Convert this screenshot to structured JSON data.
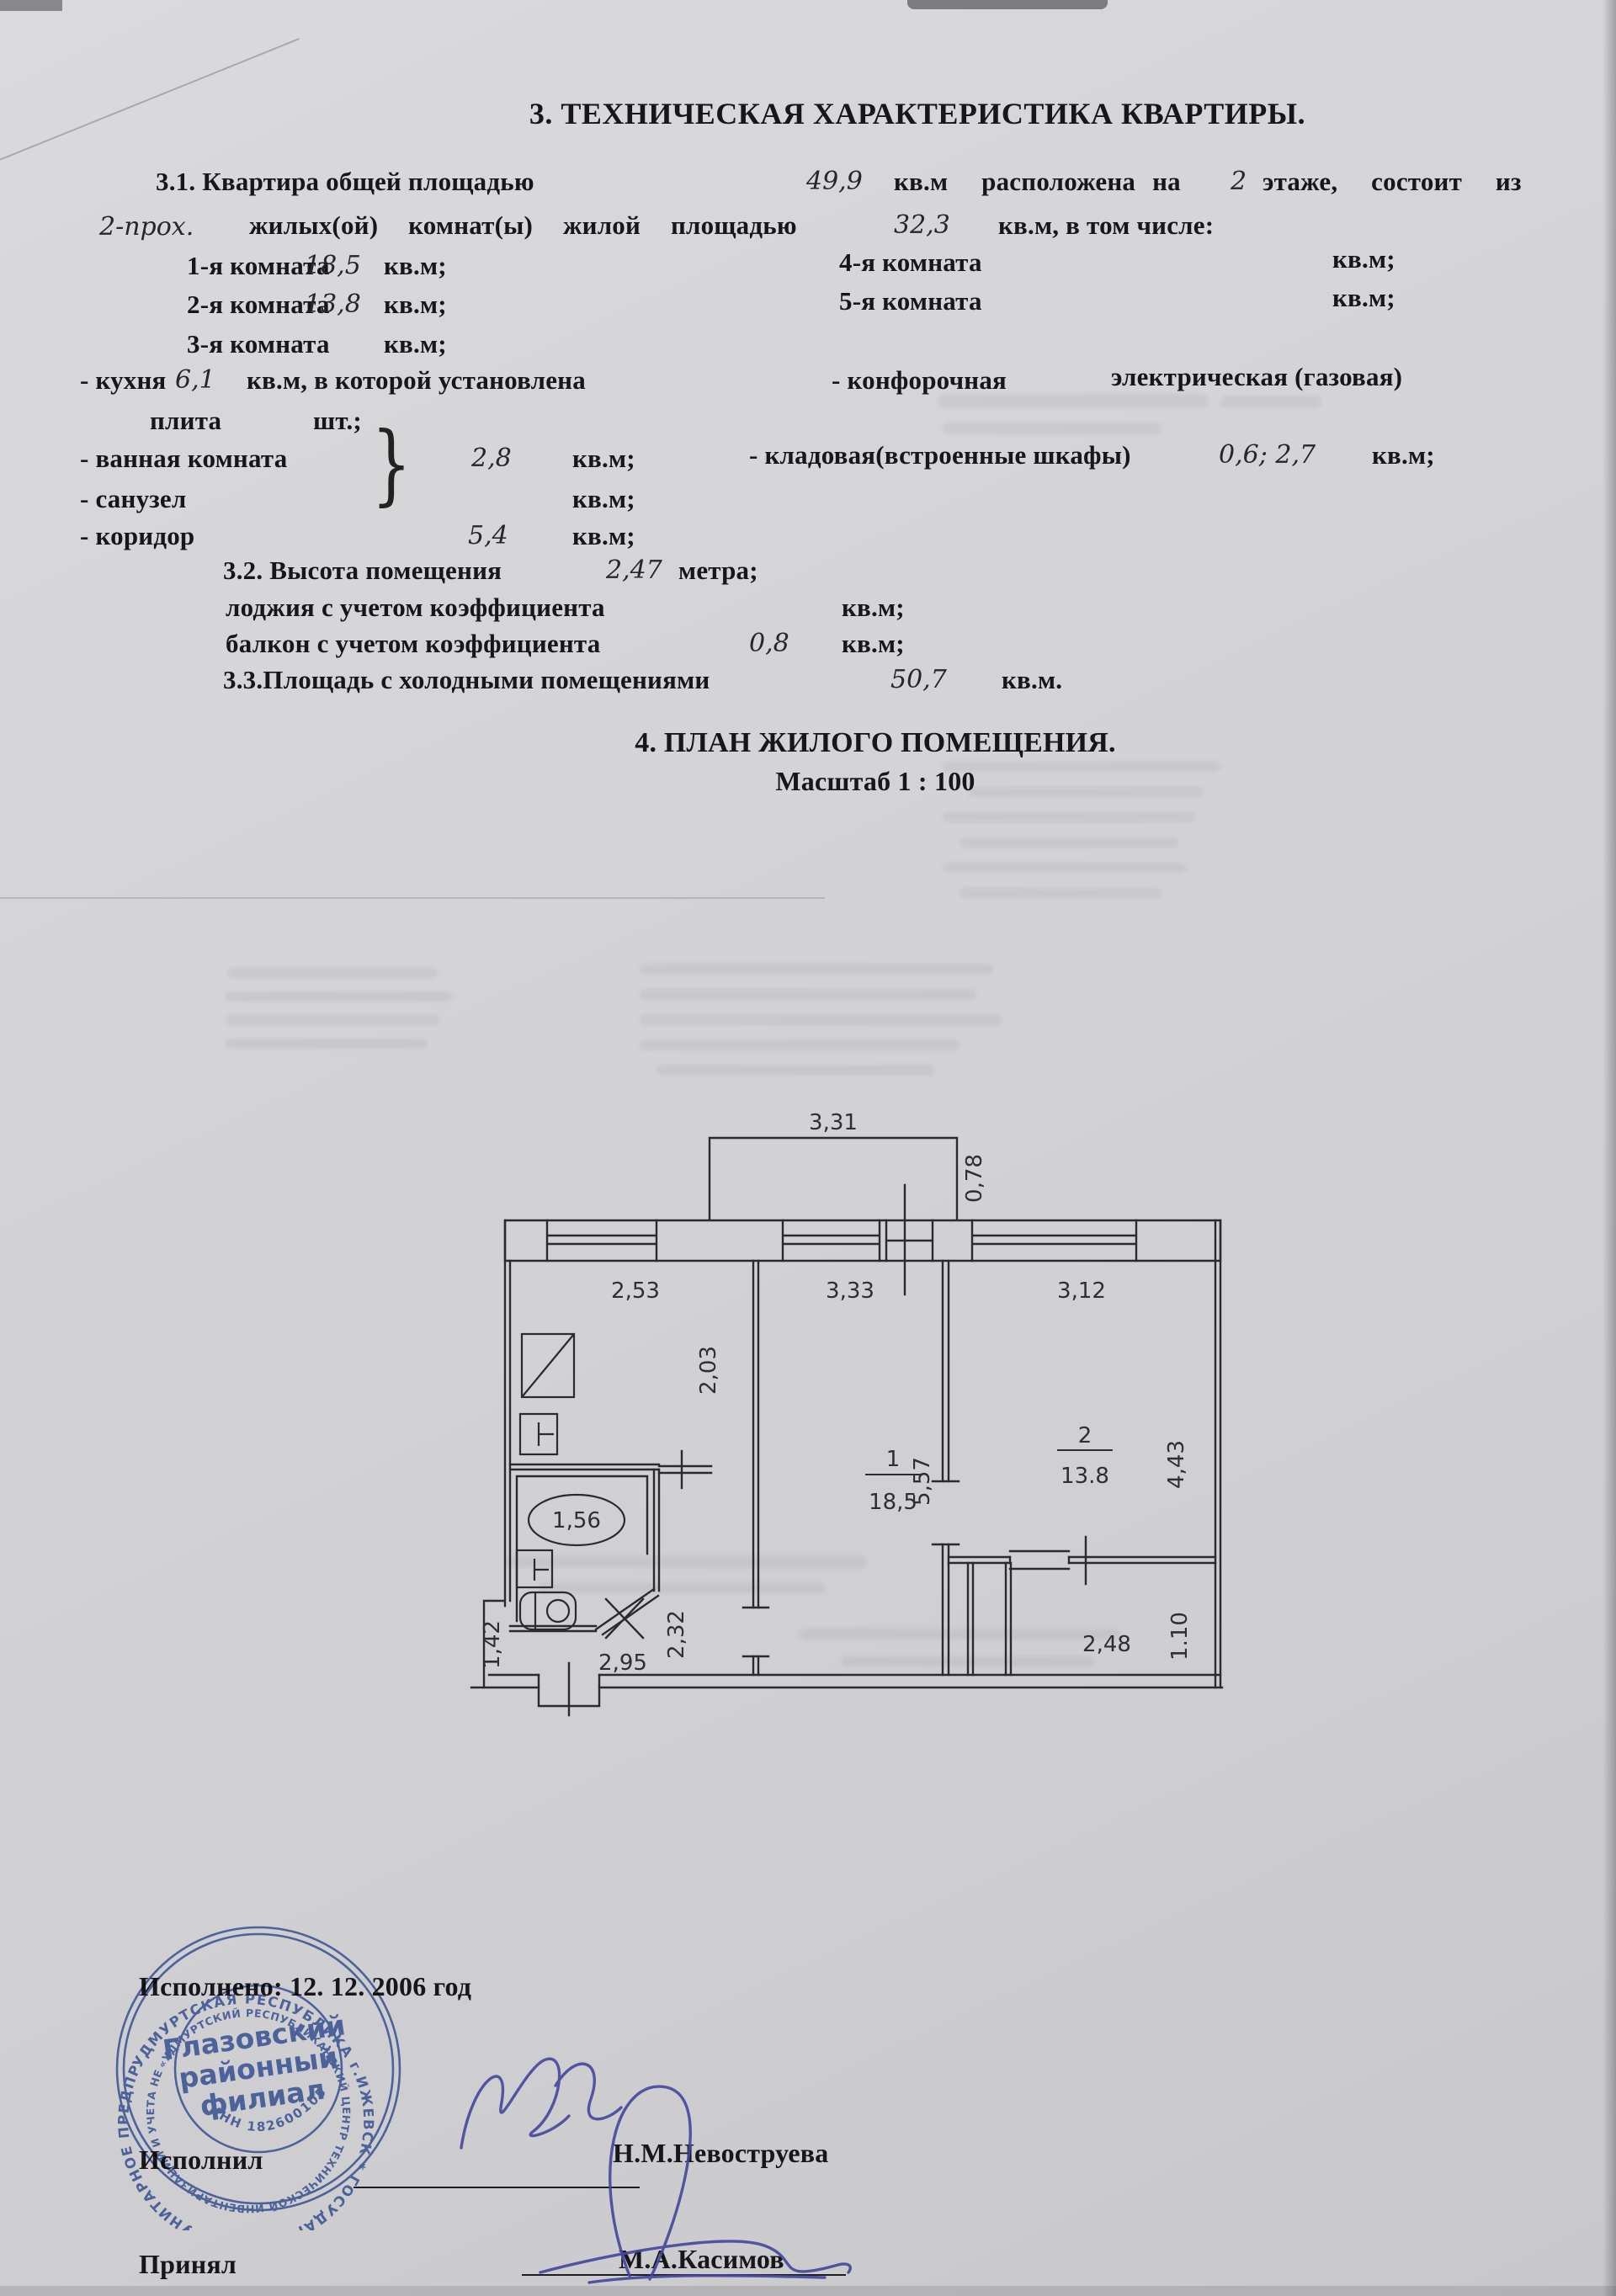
{
  "doc": {
    "section3_title": "3. ТЕХНИЧЕСКАЯ ХАРАКТЕРИСТИКА КВАРТИРЫ.",
    "p31": {
      "lead": "3.1. Квартира общей площадью",
      "total_area": "49,9",
      "mid1": "кв.м  расположена на",
      "floor": "2",
      "mid2": "этаже,  состоит  из",
      "rooms_count": "2-прох.",
      "line2": "жилых(ой)  комнат(ы)  жилой  площадью",
      "living_area": "32,3",
      "tail": "кв.м, в том числе:"
    },
    "room_rows": [
      {
        "label": "1-я комната",
        "value": "18,5",
        "unit": "кв.м;"
      },
      {
        "label": "2-я комната",
        "value": "13,8",
        "unit": "кв.м;"
      },
      {
        "label": "3-я комната",
        "value": "",
        "unit": "кв.м;"
      },
      {
        "label": "4-я комната",
        "value": "",
        "unit": "кв.м;"
      },
      {
        "label": "5-я комната",
        "value": "",
        "unit": "кв.м;"
      }
    ],
    "kitchen": {
      "label": "- кухня",
      "value": "6,1",
      "text": "кв.м, в которой установлена",
      "burner": "- конфорочная",
      "type": "электрическая (газовая)"
    },
    "plate": {
      "label": "плита",
      "unit": "шт.;"
    },
    "bath": {
      "label": "- ванная комната",
      "brace": "}",
      "value": "2,8",
      "unit": "кв.м;"
    },
    "storage": {
      "label": "- кладовая(встроенные шкафы)",
      "value": "0,6; 2,7",
      "unit": "кв.м;"
    },
    "wc": {
      "label": "- санузел",
      "unit": "кв.м;"
    },
    "corridor": {
      "label": "- коридор",
      "value": "5,4",
      "unit": "кв.м;"
    },
    "p32": {
      "label": "3.2. Высота помещения",
      "value": "2,47",
      "unit": "метра;"
    },
    "loggia": {
      "label": "лоджия с учетом коэффициента",
      "unit": "кв.м;"
    },
    "balcony": {
      "label": "балкон с учетом коэффициента",
      "value": "0,8",
      "unit": "кв.м;"
    },
    "p33": {
      "label": "3.3.Площадь с холодными помещениями",
      "value": "50,7",
      "unit": "кв.м."
    },
    "section4_title": "4. ПЛАН ЖИЛОГО ПОМЕЩЕНИЯ.",
    "scale": "Масштаб 1 : 100"
  },
  "plan": {
    "balcony_width": "3,31",
    "balcony_depth": "0,78",
    "kitchen_w": "2,53",
    "kitchen_h": "2,03",
    "bath_len": "1,56",
    "room1_no": "1",
    "room1_area": "18,5",
    "room1_w": "3,33",
    "room1_h": "5,57",
    "room2_no": "2",
    "room2_area": "13.8",
    "room2_w": "3,12",
    "room2_h": "4,43",
    "corridor_len": "2,32",
    "hall_w": "1,42",
    "hall_len": "2,95",
    "closet_w": "2,48",
    "closet_d": "1.10"
  },
  "footer": {
    "executed": "Исполнено: 12. 12. 2006 год",
    "executor_label": "Исполнил",
    "executor_name": "Н.М.Невоструева",
    "acceptor_label": "Принял",
    "acceptor_name": "М.А.Касимов",
    "stamp": {
      "center_line1": "Глазовский",
      "center_line2": "районный",
      "center_line3": "филиал",
      "ring_outer": "УДМУРТСКАЯ РЕСПУБЛИКА г.ИЖЕВСК * ГОСУДАРСТВЕННОЕ УНИТАРНОЕ ПРЕДПРИЯТИЕ *",
      "ring_inner": "«УДМУРТСКИЙ РЕСПУБЛИКАНСКИЙ ЦЕНТР ТЕХНИЧЕСКОЙ ИНВЕНТАРИЗАЦИИ И УЧЕТА НЕДВИЖИМОГО ИМУЩЕСТВА»",
      "inn": "ИНН 1826001053"
    }
  }
}
